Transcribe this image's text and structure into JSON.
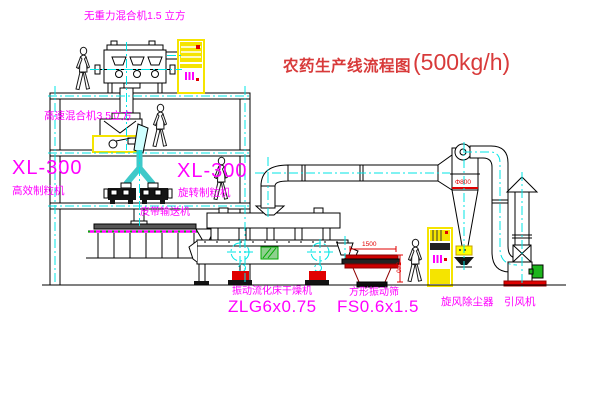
{
  "title": {
    "name": "农药生产线流程图",
    "capacity": "(500kg/h)"
  },
  "labels": {
    "gravity_mixer": "无重力混合机1.5 立方",
    "high_speed_mixer": "高速混合机3.5立方",
    "granulator_left_model": "XL-300",
    "granulator_left_name": "高效制粒机",
    "granulator_right_model": "XL-300",
    "granulator_right_name": "旋转制粒机",
    "belt_conveyor": "皮带输送机",
    "dryer_name": "振动流化床干燥机",
    "dryer_model": "ZLG6x0.75",
    "sieve_name": "方形振动筛",
    "sieve_model": "FS0.6x1.5",
    "cyclone_name": "旋风除尘器",
    "fan_name": "引风机"
  },
  "dimensions": {
    "cyclone_diameter": "Φ800",
    "sieve_width": "1500",
    "sieve_height": "540"
  },
  "colors": {
    "label": "#ff00ff",
    "title": "#d83a3a",
    "dimension": "#e00000",
    "centerline": "#00e5e5",
    "equipment_highlight": "#f5e400",
    "line": "#000000"
  }
}
